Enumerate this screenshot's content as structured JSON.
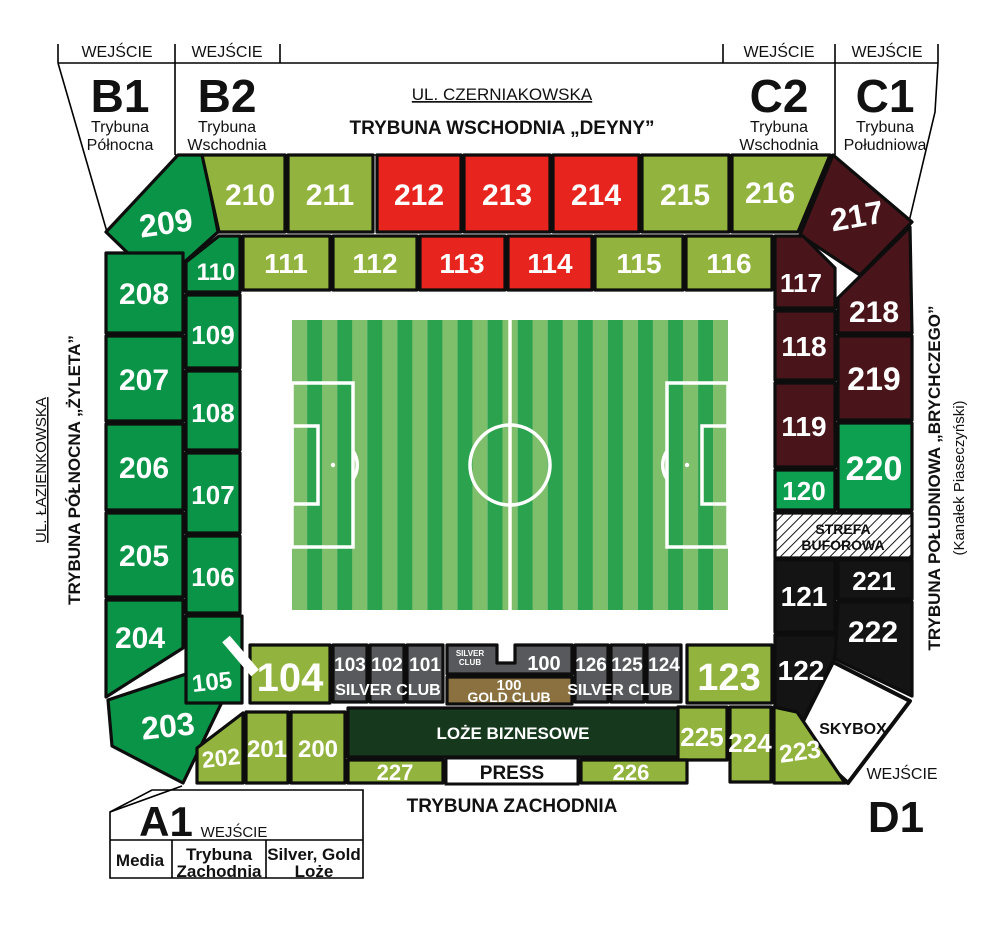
{
  "palette": {
    "olive": "#92B43E",
    "red": "#E8241E",
    "green": "#0A9448",
    "green_bright": "#0CA050",
    "maroon": "#4A151A",
    "black": "#141414",
    "gray": "#58595C",
    "gold": "#8A713F",
    "loze": "#16391E",
    "field_light": "#7FBE6B",
    "field_dark": "#2BA24D",
    "white": "#FFFFFF"
  },
  "labels": {
    "entrance": "WEJŚCIE",
    "silver_club": "SILVER CLUB",
    "silver_small_line1": "SILVER",
    "silver_small_line2": "CLUB",
    "gold_club": "GOLD CLUB",
    "press": "PRESS",
    "skybox": "SKYBOX",
    "loze_biznesowe": "LOŻE BIZNESOWE",
    "strefa_line1": "STREFA",
    "strefa_line2": "BUFOROWA"
  },
  "streets": {
    "north": "UL. CZERNIAKOWSKA",
    "west": "UL. ŁAZIENKOWSKA"
  },
  "stands": {
    "east": "TRYBUNA WSCHODNIA „DEYNY”",
    "north": "TRYBUNA PÓŁNOCNA „ŻYLETA”",
    "south": "TRYBUNA POŁUDNIOWA „BRYCHCZEGO”",
    "south_note": "(Kanałek Piaseczyński)",
    "west": "TRYBUNA ZACHODNIA"
  },
  "gates": {
    "b1": {
      "code": "B1",
      "sub1": "Trybuna",
      "sub2": "Północna"
    },
    "b2": {
      "code": "B2",
      "sub1": "Trybuna",
      "sub2": "Wschodnia"
    },
    "c2": {
      "code": "C2",
      "sub1": "Trybuna",
      "sub2": "Wschodnia"
    },
    "c1": {
      "code": "C1",
      "sub1": "Trybuna",
      "sub2": "Południowa"
    },
    "a1": {
      "code": "A1",
      "col1": "Media",
      "col2_1": "Trybuna",
      "col2_2": "Zachodnia",
      "col3_1": "Silver, Gold",
      "col3_2": "Loże"
    },
    "d1": {
      "code": "D1"
    }
  },
  "sec": {
    "s100": "100",
    "s101": "101",
    "s102": "102",
    "s103": "103",
    "s104": "104",
    "s105": "105",
    "s106": "106",
    "s107": "107",
    "s108": "108",
    "s109": "109",
    "s110": "110",
    "s111": "111",
    "s112": "112",
    "s113": "113",
    "s114": "114",
    "s115": "115",
    "s116": "116",
    "s117": "117",
    "s118": "118",
    "s119": "119",
    "s120": "120",
    "s121": "121",
    "s122": "122",
    "s123": "123",
    "s124": "124",
    "s125": "125",
    "s126": "126",
    "s200": "200",
    "s201": "201",
    "s202": "202",
    "s203": "203",
    "s204": "204",
    "s205": "205",
    "s206": "206",
    "s207": "207",
    "s208": "208",
    "s209": "209",
    "s210": "210",
    "s211": "211",
    "s212": "212",
    "s213": "213",
    "s214": "214",
    "s215": "215",
    "s216": "216",
    "s217": "217",
    "s218": "218",
    "s219": "219",
    "s220": "220",
    "s221": "221",
    "s222": "222",
    "s223": "223",
    "s224": "224",
    "s225": "225",
    "s226": "226",
    "s227": "227"
  }
}
